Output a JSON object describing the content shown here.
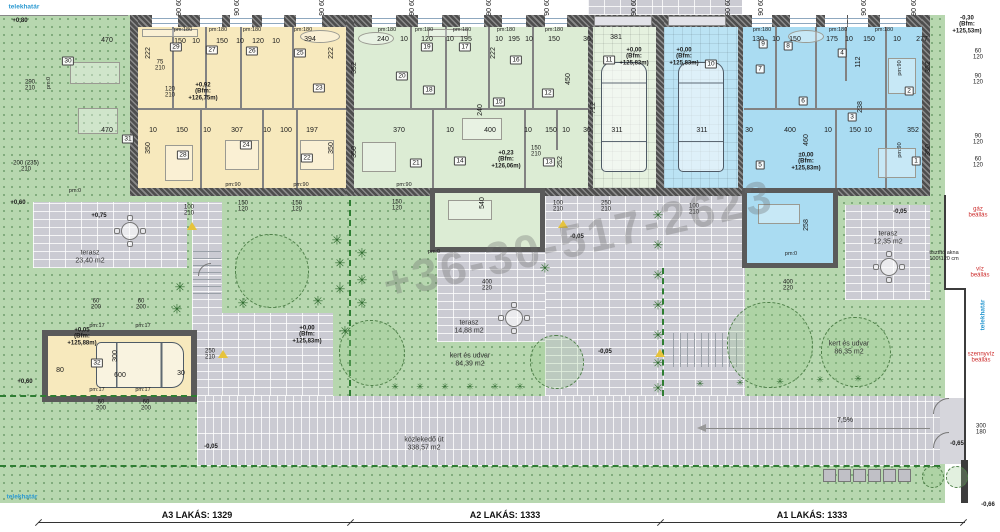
{
  "watermark": "+36-30-517-2623",
  "icons": {
    "plant": "✳"
  },
  "colors": {
    "apartment_a3": "#f7e9bd",
    "apartment_a2": "#dcecd4",
    "apartment_a1": "#aadcf2",
    "garden": "#b7d7af",
    "paving": "#cbcbd3",
    "wall": "#5a5a5a",
    "boundary_green": "#2e7d32",
    "utility_red": "#cc2a2a",
    "boundary_blue": "#2d9ad1"
  },
  "bottom_strip": {
    "a3": "A3 LAKÁS: 1329",
    "a2": "A2 LAKÁS: 1333",
    "a1": "A1 LAKÁS: 1333"
  },
  "rooms": [
    {
      "n": "30",
      "x": 68,
      "y": 61
    },
    {
      "n": "29",
      "x": 176,
      "y": 47
    },
    {
      "n": "27",
      "x": 212,
      "y": 50
    },
    {
      "n": "26",
      "x": 252,
      "y": 51
    },
    {
      "n": "25",
      "x": 300,
      "y": 53
    },
    {
      "n": "23",
      "x": 319,
      "y": 88
    },
    {
      "n": "31",
      "x": 128,
      "y": 139
    },
    {
      "n": "28",
      "x": 183,
      "y": 155
    },
    {
      "n": "24",
      "x": 246,
      "y": 145
    },
    {
      "n": "22",
      "x": 307,
      "y": 158
    },
    {
      "n": "19",
      "x": 427,
      "y": 47
    },
    {
      "n": "17",
      "x": 465,
      "y": 47
    },
    {
      "n": "20",
      "x": 402,
      "y": 76
    },
    {
      "n": "18",
      "x": 429,
      "y": 90
    },
    {
      "n": "16",
      "x": 516,
      "y": 60
    },
    {
      "n": "15",
      "x": 499,
      "y": 102
    },
    {
      "n": "12",
      "x": 548,
      "y": 93
    },
    {
      "n": "11",
      "x": 609,
      "y": 60
    },
    {
      "n": "21",
      "x": 416,
      "y": 163
    },
    {
      "n": "14",
      "x": 460,
      "y": 161
    },
    {
      "n": "13",
      "x": 549,
      "y": 162
    },
    {
      "n": "9",
      "x": 763,
      "y": 44
    },
    {
      "n": "8",
      "x": 788,
      "y": 46
    },
    {
      "n": "4",
      "x": 842,
      "y": 53
    },
    {
      "n": "10",
      "x": 711,
      "y": 64
    },
    {
      "n": "7",
      "x": 760,
      "y": 69
    },
    {
      "n": "6",
      "x": 803,
      "y": 101
    },
    {
      "n": "3",
      "x": 852,
      "y": 117
    },
    {
      "n": "2",
      "x": 909,
      "y": 91
    },
    {
      "n": "5",
      "x": 760,
      "y": 165
    },
    {
      "n": "1",
      "x": 916,
      "y": 161
    },
    {
      "n": "32",
      "x": 97,
      "y": 363
    }
  ],
  "annotations": [
    {
      "t": "telekhatár",
      "x": 24,
      "y": 7,
      "c": "blue"
    },
    {
      "t": "+0,80",
      "x": 20,
      "y": 21,
      "c": "lvl"
    },
    {
      "t": "90 60",
      "x": 180,
      "y": 7,
      "r": 1
    },
    {
      "t": "90 60",
      "x": 238,
      "y": 7,
      "r": 1
    },
    {
      "t": "90 60",
      "x": 323,
      "y": 7,
      "r": 1
    },
    {
      "t": "90 60",
      "x": 413,
      "y": 7,
      "r": 1
    },
    {
      "t": "90 60",
      "x": 490,
      "y": 7,
      "r": 1
    },
    {
      "t": "90 60",
      "x": 548,
      "y": 7,
      "r": 1
    },
    {
      "t": "90 60",
      "x": 635,
      "y": 7,
      "r": 1
    },
    {
      "t": "90 60",
      "x": 729,
      "y": 7,
      "r": 1
    },
    {
      "t": "90 60",
      "x": 762,
      "y": 7,
      "r": 1
    },
    {
      "t": "90 60",
      "x": 865,
      "y": 7,
      "r": 1
    },
    {
      "t": "90 60",
      "x": 915,
      "y": 7,
      "r": 1
    },
    {
      "t": "290\n210",
      "x": 30,
      "y": 86,
      "c": "frac"
    },
    {
      "t": "200 (235)\n210",
      "x": 26,
      "y": 167,
      "c": "frac"
    },
    {
      "t": "+0,60",
      "x": 18,
      "y": 203,
      "c": "lvl"
    },
    {
      "t": "+0,60",
      "x": 25,
      "y": 382,
      "c": "lvl"
    },
    {
      "t": "telekhatár",
      "x": 22,
      "y": 497,
      "c": "blue"
    },
    {
      "t": "-0,30\n(Bfm:\n+125,53m)",
      "x": 967,
      "y": 25,
      "c": "lvl"
    },
    {
      "t": "60\n120",
      "x": 978,
      "y": 55,
      "c": "frac"
    },
    {
      "t": "90\n120",
      "x": 978,
      "y": 80,
      "c": "frac"
    },
    {
      "t": "90\n120",
      "x": 978,
      "y": 140,
      "c": "frac"
    },
    {
      "t": "60\n120",
      "x": 978,
      "y": 163,
      "c": "frac"
    },
    {
      "t": "gáz\nbeállás",
      "x": 978,
      "y": 213,
      "c": "red"
    },
    {
      "t": "tisztító akna\n100*120 cm",
      "x": 944,
      "y": 257,
      "c": "tiny"
    },
    {
      "t": "víz\nbeállás",
      "x": 980,
      "y": 273,
      "c": "red"
    },
    {
      "t": "telekhatár",
      "x": 983,
      "y": 315,
      "c": "blue",
      "r": 1
    },
    {
      "t": "szennyvíz\nbeállás",
      "x": 981,
      "y": 358,
      "c": "red"
    },
    {
      "t": "300\n180",
      "x": 981,
      "y": 430,
      "c": "frac"
    },
    {
      "t": "-0,65",
      "x": 957,
      "y": 444,
      "c": "lvl"
    },
    {
      "t": "-0,66",
      "x": 988,
      "y": 505,
      "c": "lvl"
    },
    {
      "t": "470",
      "x": 107,
      "y": 41
    },
    {
      "t": "150",
      "x": 180,
      "y": 42
    },
    {
      "t": "10",
      "x": 196,
      "y": 42
    },
    {
      "t": "150",
      "x": 222,
      "y": 42
    },
    {
      "t": "10",
      "x": 240,
      "y": 42
    },
    {
      "t": "120",
      "x": 258,
      "y": 42
    },
    {
      "t": "10",
      "x": 276,
      "y": 42
    },
    {
      "t": "394",
      "x": 310,
      "y": 40
    },
    {
      "t": "pm:180",
      "x": 183,
      "y": 31,
      "c": "tiny"
    },
    {
      "t": "pm:180",
      "x": 218,
      "y": 31,
      "c": "tiny"
    },
    {
      "t": "pm:180",
      "x": 252,
      "y": 31,
      "c": "tiny"
    },
    {
      "t": "pm:180",
      "x": 303,
      "y": 31,
      "c": "tiny"
    },
    {
      "t": "222",
      "x": 149,
      "y": 53,
      "r": 1
    },
    {
      "t": "350",
      "x": 149,
      "y": 148,
      "r": 1
    },
    {
      "t": "222",
      "x": 332,
      "y": 53,
      "r": 1
    },
    {
      "t": "350",
      "x": 332,
      "y": 148,
      "r": 1
    },
    {
      "t": "75\n210",
      "x": 160,
      "y": 66,
      "c": "frac"
    },
    {
      "t": "120\n210",
      "x": 170,
      "y": 93,
      "c": "frac"
    },
    {
      "t": "+0,92\n(Bfm:\n+126,75m)",
      "x": 203,
      "y": 92,
      "c": "lvl"
    },
    {
      "t": "470",
      "x": 107,
      "y": 131
    },
    {
      "t": "10",
      "x": 153,
      "y": 131
    },
    {
      "t": "150",
      "x": 182,
      "y": 131
    },
    {
      "t": "10",
      "x": 207,
      "y": 131
    },
    {
      "t": "307",
      "x": 237,
      "y": 131
    },
    {
      "t": "10",
      "x": 267,
      "y": 131
    },
    {
      "t": "100",
      "x": 286,
      "y": 131
    },
    {
      "t": "197",
      "x": 312,
      "y": 131
    },
    {
      "t": "pm:0",
      "x": 75,
      "y": 192,
      "c": "tiny"
    },
    {
      "t": "pm:0",
      "x": 50,
      "y": 83,
      "c": "tiny",
      "r": 1
    },
    {
      "t": "pm:90",
      "x": 233,
      "y": 186,
      "c": "tiny"
    },
    {
      "t": "pm:90",
      "x": 301,
      "y": 186,
      "c": "tiny"
    },
    {
      "t": "240",
      "x": 383,
      "y": 40
    },
    {
      "t": "10",
      "x": 404,
      "y": 40
    },
    {
      "t": "120",
      "x": 427,
      "y": 40
    },
    {
      "t": "10",
      "x": 450,
      "y": 40
    },
    {
      "t": "195",
      "x": 466,
      "y": 40
    },
    {
      "t": "10",
      "x": 499,
      "y": 40
    },
    {
      "t": "195",
      "x": 514,
      "y": 40
    },
    {
      "t": "10",
      "x": 529,
      "y": 40
    },
    {
      "t": "150",
      "x": 554,
      "y": 40
    },
    {
      "t": "30",
      "x": 587,
      "y": 40
    },
    {
      "t": "381",
      "x": 616,
      "y": 38
    },
    {
      "t": "pm:180",
      "x": 387,
      "y": 31,
      "c": "tiny"
    },
    {
      "t": "pm:180",
      "x": 424,
      "y": 31,
      "c": "tiny"
    },
    {
      "t": "pm:180",
      "x": 462,
      "y": 31,
      "c": "tiny"
    },
    {
      "t": "pm:180",
      "x": 506,
      "y": 31,
      "c": "tiny"
    },
    {
      "t": "pm:180",
      "x": 554,
      "y": 31,
      "c": "tiny"
    },
    {
      "t": "352",
      "x": 355,
      "y": 68,
      "r": 1
    },
    {
      "t": "222",
      "x": 494,
      "y": 53,
      "r": 1
    },
    {
      "t": "240",
      "x": 481,
      "y": 110,
      "r": 1
    },
    {
      "t": "450",
      "x": 569,
      "y": 79,
      "r": 1
    },
    {
      "t": "712",
      "x": 594,
      "y": 108,
      "r": 1
    },
    {
      "t": "350",
      "x": 355,
      "y": 152,
      "r": 1
    },
    {
      "t": "252",
      "x": 561,
      "y": 162,
      "r": 1
    },
    {
      "t": "+0,00\n(Bfm:\n+125,83m)",
      "x": 634,
      "y": 57,
      "c": "lvl"
    },
    {
      "t": "+0,23\n(Bfm:\n+126,06m)",
      "x": 506,
      "y": 160,
      "c": "lvl"
    },
    {
      "t": "370",
      "x": 399,
      "y": 131
    },
    {
      "t": "10",
      "x": 450,
      "y": 131
    },
    {
      "t": "400",
      "x": 490,
      "y": 131
    },
    {
      "t": "10",
      "x": 528,
      "y": 131
    },
    {
      "t": "150",
      "x": 551,
      "y": 131
    },
    {
      "t": "10",
      "x": 566,
      "y": 131
    },
    {
      "t": "30",
      "x": 587,
      "y": 131
    },
    {
      "t": "311",
      "x": 617,
      "y": 131
    },
    {
      "t": "pm:90",
      "x": 404,
      "y": 186,
      "c": "tiny"
    },
    {
      "t": "150\n210",
      "x": 536,
      "y": 152,
      "c": "frac"
    },
    {
      "t": "540",
      "x": 483,
      "y": 203,
      "r": 1
    },
    {
      "t": "pm:0",
      "x": 434,
      "y": 253,
      "c": "tiny"
    },
    {
      "t": "400\n220",
      "x": 487,
      "y": 286,
      "c": "frac"
    },
    {
      "t": "100\n210",
      "x": 558,
      "y": 207,
      "c": "frac"
    },
    {
      "t": "250\n210",
      "x": 606,
      "y": 207,
      "c": "frac"
    },
    {
      "t": "-0,05",
      "x": 577,
      "y": 237,
      "c": "lvl"
    },
    {
      "t": "-0,05",
      "x": 605,
      "y": 352,
      "c": "lvl"
    },
    {
      "t": "130",
      "x": 758,
      "y": 40
    },
    {
      "t": "10",
      "x": 776,
      "y": 40
    },
    {
      "t": "150",
      "x": 795,
      "y": 40
    },
    {
      "t": "175",
      "x": 832,
      "y": 40
    },
    {
      "t": "10",
      "x": 849,
      "y": 40
    },
    {
      "t": "150",
      "x": 869,
      "y": 40
    },
    {
      "t": "10",
      "x": 897,
      "y": 40
    },
    {
      "t": "277",
      "x": 922,
      "y": 40
    },
    {
      "t": "pm:180",
      "x": 762,
      "y": 31,
      "c": "tiny"
    },
    {
      "t": "pm:180",
      "x": 838,
      "y": 31,
      "c": "tiny"
    },
    {
      "t": "pm:180",
      "x": 884,
      "y": 31,
      "c": "tiny"
    },
    {
      "t": "112",
      "x": 859,
      "y": 62,
      "r": 1
    },
    {
      "t": "238",
      "x": 861,
      "y": 107,
      "r": 1
    },
    {
      "t": "460",
      "x": 807,
      "y": 140,
      "r": 1
    },
    {
      "t": "352",
      "x": 929,
      "y": 67,
      "r": 1
    },
    {
      "t": "350",
      "x": 929,
      "y": 150,
      "r": 1
    },
    {
      "t": "258",
      "x": 807,
      "y": 225,
      "r": 1
    },
    {
      "t": "+0,00\n(Bfm:\n+125,83m)",
      "x": 684,
      "y": 57,
      "c": "lvl"
    },
    {
      "t": "±0,00\n(Bfm:\n+125,83m)",
      "x": 806,
      "y": 162,
      "c": "lvl"
    },
    {
      "t": "311",
      "x": 702,
      "y": 131
    },
    {
      "t": "30",
      "x": 749,
      "y": 131
    },
    {
      "t": "400",
      "x": 790,
      "y": 131
    },
    {
      "t": "10",
      "x": 828,
      "y": 131
    },
    {
      "t": "150",
      "x": 855,
      "y": 131
    },
    {
      "t": "10",
      "x": 868,
      "y": 131
    },
    {
      "t": "352",
      "x": 913,
      "y": 131
    },
    {
      "t": "pm:90",
      "x": 901,
      "y": 68,
      "c": "tiny",
      "r": 1
    },
    {
      "t": "pm:90",
      "x": 901,
      "y": 150,
      "c": "tiny",
      "r": 1
    },
    {
      "t": "pm:0",
      "x": 791,
      "y": 255,
      "c": "tiny"
    },
    {
      "t": "400\n220",
      "x": 788,
      "y": 286,
      "c": "frac"
    },
    {
      "t": "100\n210",
      "x": 694,
      "y": 210,
      "c": "frac"
    },
    {
      "t": "-0,05",
      "x": 900,
      "y": 212,
      "c": "lvl"
    },
    {
      "t": "terasz\n23,40 m2",
      "x": 90,
      "y": 257,
      "c": "area"
    },
    {
      "t": "+0,75",
      "x": 99,
      "y": 216,
      "c": "lvl"
    },
    {
      "t": "100\n210",
      "x": 189,
      "y": 211,
      "c": "frac"
    },
    {
      "t": "150\n120",
      "x": 243,
      "y": 207,
      "c": "frac"
    },
    {
      "t": "150\n120",
      "x": 297,
      "y": 207,
      "c": "frac"
    },
    {
      "t": "150\n120",
      "x": 397,
      "y": 206,
      "c": "frac"
    },
    {
      "t": "60\n200",
      "x": 96,
      "y": 305,
      "c": "frac"
    },
    {
      "t": "60\n200",
      "x": 141,
      "y": 305,
      "c": "frac"
    },
    {
      "t": "60\n200",
      "x": 101,
      "y": 406,
      "c": "frac"
    },
    {
      "t": "60\n200",
      "x": 146,
      "y": 406,
      "c": "frac"
    },
    {
      "t": "+0,05\n(Bfm:\n+125,88m)",
      "x": 82,
      "y": 337,
      "c": "lvl"
    },
    {
      "t": "600",
      "x": 120,
      "y": 376
    },
    {
      "t": "300",
      "x": 116,
      "y": 356,
      "r": 1
    },
    {
      "t": "30",
      "x": 181,
      "y": 374
    },
    {
      "t": "80",
      "x": 60,
      "y": 371
    },
    {
      "t": "pm:17",
      "x": 97,
      "y": 327,
      "c": "tiny"
    },
    {
      "t": "pm:17",
      "x": 143,
      "y": 327,
      "c": "tiny"
    },
    {
      "t": "pm:17",
      "x": 97,
      "y": 391,
      "c": "tiny"
    },
    {
      "t": "pm:17",
      "x": 143,
      "y": 391,
      "c": "tiny"
    },
    {
      "t": "250\n210",
      "x": 210,
      "y": 355,
      "c": "frac"
    },
    {
      "t": "+0,00\n(Bfm:\n+125,83m)",
      "x": 307,
      "y": 335,
      "c": "lvl"
    },
    {
      "t": "-0,05",
      "x": 211,
      "y": 447,
      "c": "lvl"
    },
    {
      "t": "terasz\n14,88 m2",
      "x": 469,
      "y": 327,
      "c": "area"
    },
    {
      "t": "kert és udvar\n84,39 m2",
      "x": 470,
      "y": 360,
      "c": "area"
    },
    {
      "t": "terasz\n12,35 m2",
      "x": 888,
      "y": 238,
      "c": "area"
    },
    {
      "t": "kert és udvar\n86,35 m2",
      "x": 849,
      "y": 348,
      "c": "area"
    },
    {
      "t": "közlekedő út\n338,57 m2",
      "x": 424,
      "y": 444,
      "c": "area"
    },
    {
      "t": "7,5%",
      "x": 845,
      "y": 421
    }
  ],
  "plants": {
    "palms": [
      [
        180,
        287
      ],
      [
        177,
        309
      ],
      [
        243,
        303
      ],
      [
        318,
        301
      ],
      [
        337,
        240
      ],
      [
        340,
        263
      ],
      [
        340,
        289
      ],
      [
        345,
        331
      ],
      [
        362,
        253
      ],
      [
        362,
        280
      ],
      [
        362,
        303
      ],
      [
        545,
        268
      ],
      [
        658,
        215
      ],
      [
        658,
        245
      ],
      [
        658,
        275
      ],
      [
        658,
        305
      ],
      [
        658,
        335
      ],
      [
        658,
        363
      ],
      [
        658,
        388
      ]
    ],
    "hedge": [
      [
        395,
        387
      ],
      [
        420,
        387
      ],
      [
        445,
        387
      ],
      [
        470,
        387
      ],
      [
        495,
        387
      ],
      [
        520,
        387
      ],
      [
        700,
        384
      ],
      [
        740,
        383
      ],
      [
        780,
        382
      ],
      [
        820,
        380
      ],
      [
        858,
        379
      ]
    ]
  },
  "trees": [
    {
      "x": 272,
      "y": 271,
      "r": 37
    },
    {
      "x": 372,
      "y": 353,
      "r": 33
    },
    {
      "x": 557,
      "y": 362,
      "r": 27
    },
    {
      "x": 770,
      "y": 345,
      "r": 43
    },
    {
      "x": 856,
      "y": 352,
      "r": 35
    },
    {
      "x": 933,
      "y": 477,
      "r": 11
    },
    {
      "x": 957,
      "y": 477,
      "r": 11
    }
  ],
  "tables": [
    [
      130,
      231
    ],
    [
      514,
      318
    ],
    [
      889,
      267
    ]
  ],
  "cars": [
    {
      "x": 601,
      "y": 62,
      "w": 46,
      "h": 110,
      "o": "v"
    },
    {
      "x": 678,
      "y": 62,
      "w": 46,
      "h": 110,
      "o": "v"
    },
    {
      "x": 96,
      "y": 342,
      "w": 88,
      "h": 46,
      "o": "h"
    }
  ],
  "parking": {
    "count": 6,
    "x": 823,
    "y": 469,
    "step": 15,
    "size": 13
  },
  "windows": {
    "front": [
      [
        152,
        26
      ],
      [
        200,
        22
      ],
      [
        230,
        22
      ],
      [
        262,
        22
      ],
      [
        296,
        26
      ],
      [
        372,
        24
      ],
      [
        418,
        24
      ],
      [
        460,
        24
      ],
      [
        502,
        24
      ],
      [
        545,
        22
      ],
      [
        752,
        20
      ],
      [
        790,
        26
      ],
      [
        825,
        22
      ],
      [
        848,
        20
      ],
      [
        880,
        26
      ]
    ],
    "garage_doors": [
      [
        594,
        58
      ],
      [
        668,
        58
      ]
    ]
  },
  "triangles": [
    [
      187,
      222
    ],
    [
      218,
      350
    ],
    [
      558,
      220
    ],
    [
      655,
      349
    ]
  ]
}
